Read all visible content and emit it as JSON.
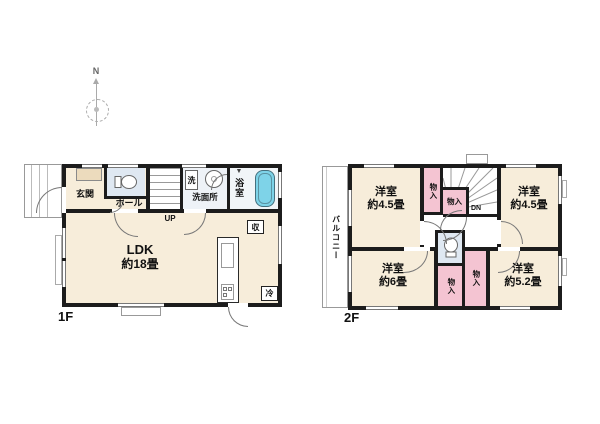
{
  "title": "2-story house floor plan",
  "colors": {
    "wall": "#1c1c1c",
    "room_cream": "#f7edda",
    "closet_pink": "#f4c4d2",
    "toilet_blue": "#dfe8f2",
    "bathtub_blue": "#7ed3e8",
    "closet_beige": "#ecdbbd"
  },
  "compass": {
    "north_label": "N"
  },
  "floor1": {
    "floor_label": "1F",
    "entrance_label": "玄関",
    "hall_label": "ホール",
    "washer_label": "洗",
    "washroom_label": "洗面所",
    "bathroom_label": "浴室",
    "stairs_label": "UP",
    "ldk_name": "LDK",
    "ldk_size": "約18畳",
    "storage_label": "収",
    "fridge_label": "冷",
    "bath_vent_marker": "▼"
  },
  "floor2": {
    "floor_label": "2F",
    "balcony_label": "バルコニー",
    "stairs_label": "DN",
    "rooms": {
      "nw": {
        "name": "洋室",
        "size": "約4.5畳"
      },
      "ne": {
        "name": "洋室",
        "size": "約4.5畳"
      },
      "sw": {
        "name": "洋室",
        "size": "約6畳"
      },
      "se": {
        "name": "洋室",
        "size": "約5.2畳"
      }
    },
    "closets": {
      "c1": "物入",
      "c2": "物入",
      "c3": "物入",
      "c4": "物入"
    }
  }
}
